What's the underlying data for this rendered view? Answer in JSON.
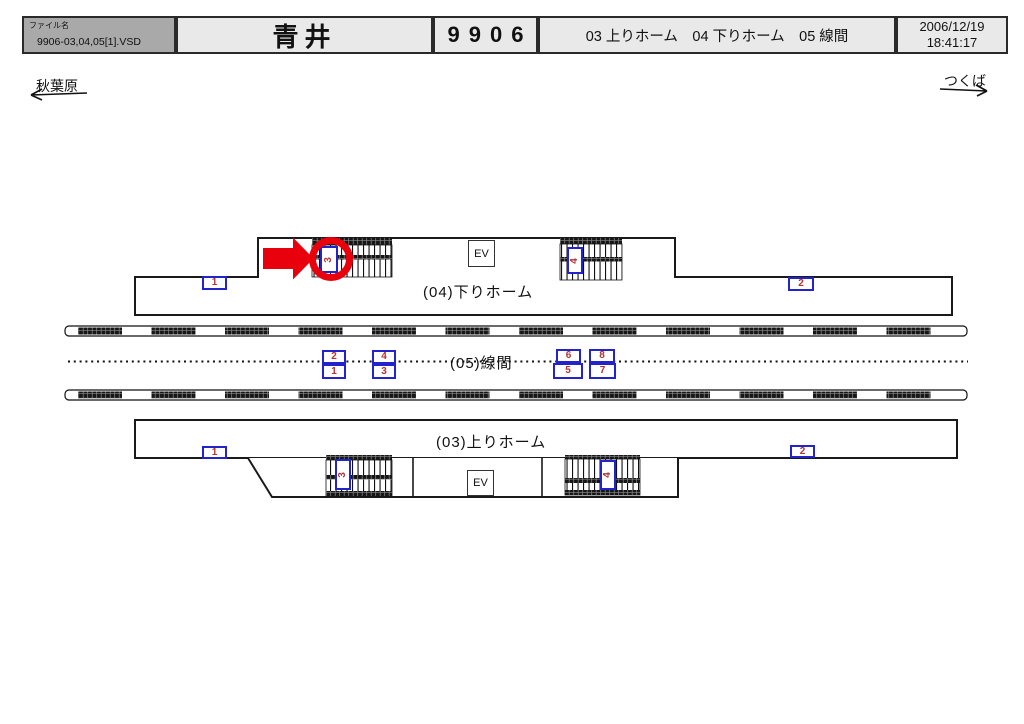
{
  "header": {
    "file_label": "ファイル名",
    "file_name": "9906-03,04,05[1].VSD",
    "station_name": "青井",
    "station_code": "9906",
    "sections": "03 上りホーム　04 下りホーム　05 線間",
    "date": "2006/12/19",
    "time": "18:41:17"
  },
  "directions": {
    "left": "秋葉原",
    "right": "つくば"
  },
  "diagram": {
    "down_platform_label": "(04)下りホーム",
    "between_lines_label": "(05)線間",
    "up_platform_label": "(03)上りホーム",
    "elevator_label": "EV",
    "upper_signs": {
      "left": "1",
      "right": "2",
      "stair_left": "3",
      "stair_right": "4"
    },
    "lower_signs": {
      "left": "1",
      "right": "2",
      "stair_left": "3",
      "stair_right": "4"
    },
    "between_sign_pairs": [
      {
        "top": "2",
        "bottom": "1"
      },
      {
        "top": "4",
        "bottom": "3"
      },
      {
        "top": "6",
        "bottom": "5"
      },
      {
        "top": "8",
        "bottom": "7"
      }
    ],
    "highlight": {
      "marker": "red-arrow-and-circle",
      "target_sign": "3"
    }
  },
  "colors": {
    "highlight_red": "#e8000d",
    "sign_border_blue": "#2323cc",
    "sign_number_red": "#b43333",
    "header_fill": "#e9e9e9",
    "filename_fill": "#a9a9a9",
    "line_black": "#1a1a1a"
  }
}
